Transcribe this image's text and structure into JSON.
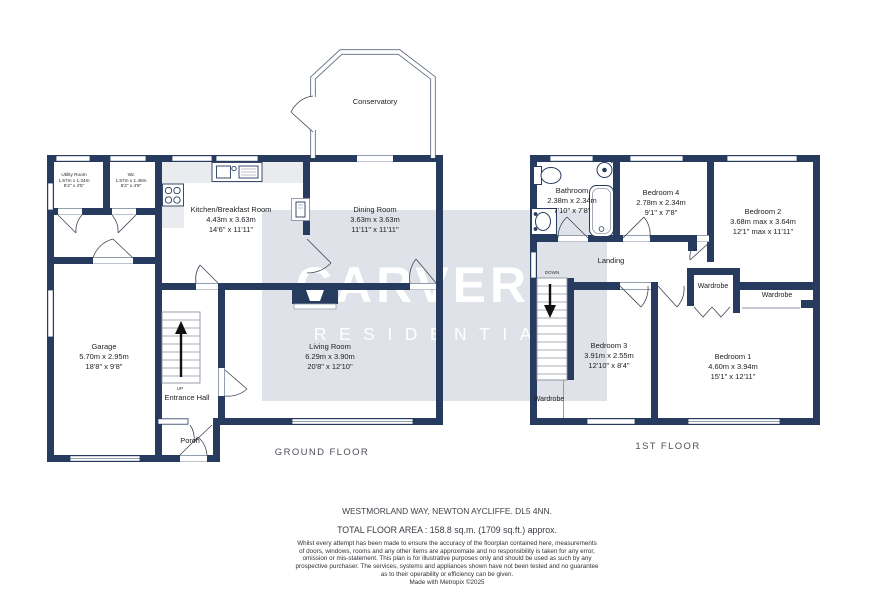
{
  "watermark": {
    "line1": "CARVER",
    "line2": "RESIDENTIAL"
  },
  "ground_floor": {
    "label": "GROUND FLOOR",
    "rooms": {
      "utility": {
        "name": "Utility Room",
        "metric": "1.57m x 1.34m",
        "imperial": "5'2\" x 4'5\""
      },
      "wc": {
        "name": "Wc",
        "metric": "1.57m x 1.45m",
        "imperial": "5'2\" x 4'9\""
      },
      "kitchen": {
        "name": "Kitchen/Breakfast Room",
        "metric": "4.43m x 3.63m",
        "imperial": "14'6\" x 11'11\""
      },
      "dining": {
        "name": "Dining Room",
        "metric": "3.63m x 3.63m",
        "imperial": "11'11\" x 11'11\""
      },
      "conservatory": {
        "name": "Conservatory"
      },
      "living": {
        "name": "Living Room",
        "metric": "6.29m x 3.90m",
        "imperial": "20'8\" x 12'10\""
      },
      "garage": {
        "name": "Garage",
        "metric": "5.70m x 2.95m",
        "imperial": "18'8\" x 9'8\""
      },
      "entrance_hall": {
        "name": "Entrance Hall"
      },
      "porch": {
        "name": "Porch"
      },
      "stairs": {
        "direction": "UP"
      }
    }
  },
  "first_floor": {
    "label": "1ST FLOOR",
    "rooms": {
      "bathroom": {
        "name": "Bathroom",
        "metric": "2.38m x 2.34m",
        "imperial": "7'10\" x 7'8\""
      },
      "bedroom4": {
        "name": "Bedroom 4",
        "metric": "2.78m x 2.34m",
        "imperial": "9'1\" x 7'8\""
      },
      "bedroom2": {
        "name": "Bedroom 2",
        "metric": "3.68m max x 3.64m",
        "imperial": "12'1\" max x 11'11\""
      },
      "bedroom3": {
        "name": "Bedroom 3",
        "metric": "3.91m x 2.55m",
        "imperial": "12'10\" x 8'4\""
      },
      "bedroom1": {
        "name": "Bedroom 1",
        "metric": "4.60m x 3.94m",
        "imperial": "15'1\" x 12'11\""
      },
      "landing": {
        "name": "Landing"
      },
      "wardrobe_bed2": {
        "name": "Wardrobe"
      },
      "wardrobe_bed1": {
        "name": "Wardrobe"
      },
      "wardrobe_stairs": {
        "name": "Wardrobe"
      },
      "stairs": {
        "direction": "DOWN"
      }
    }
  },
  "footer": {
    "address": "WESTMORLAND WAY, NEWTON AYCLIFFE. DL5 4NN.",
    "total_area": "TOTAL FLOOR AREA : 158.8 sq.m. (1709 sq.ft.) approx.",
    "disclaimer": [
      "Whilst every attempt has been made to ensure the accuracy of the floorplan contained here, measurements",
      "of doors, windows, rooms and any other items are approximate and no responsibility is taken for any error,",
      "omission or mis-statement. This plan is for illustrative purposes only and should be used as such by any",
      "prospective purchaser. The services, systems and appliances shown have not been tested and no guarantee",
      "as to their operability or efficiency can be given."
    ],
    "credit": "Made with Metropix ©2025"
  },
  "colors": {
    "wall": "#263b5e",
    "watermark_bg": "#dfe2e8",
    "watermark_text": "#ffffff",
    "counter": "#e9ebee"
  }
}
